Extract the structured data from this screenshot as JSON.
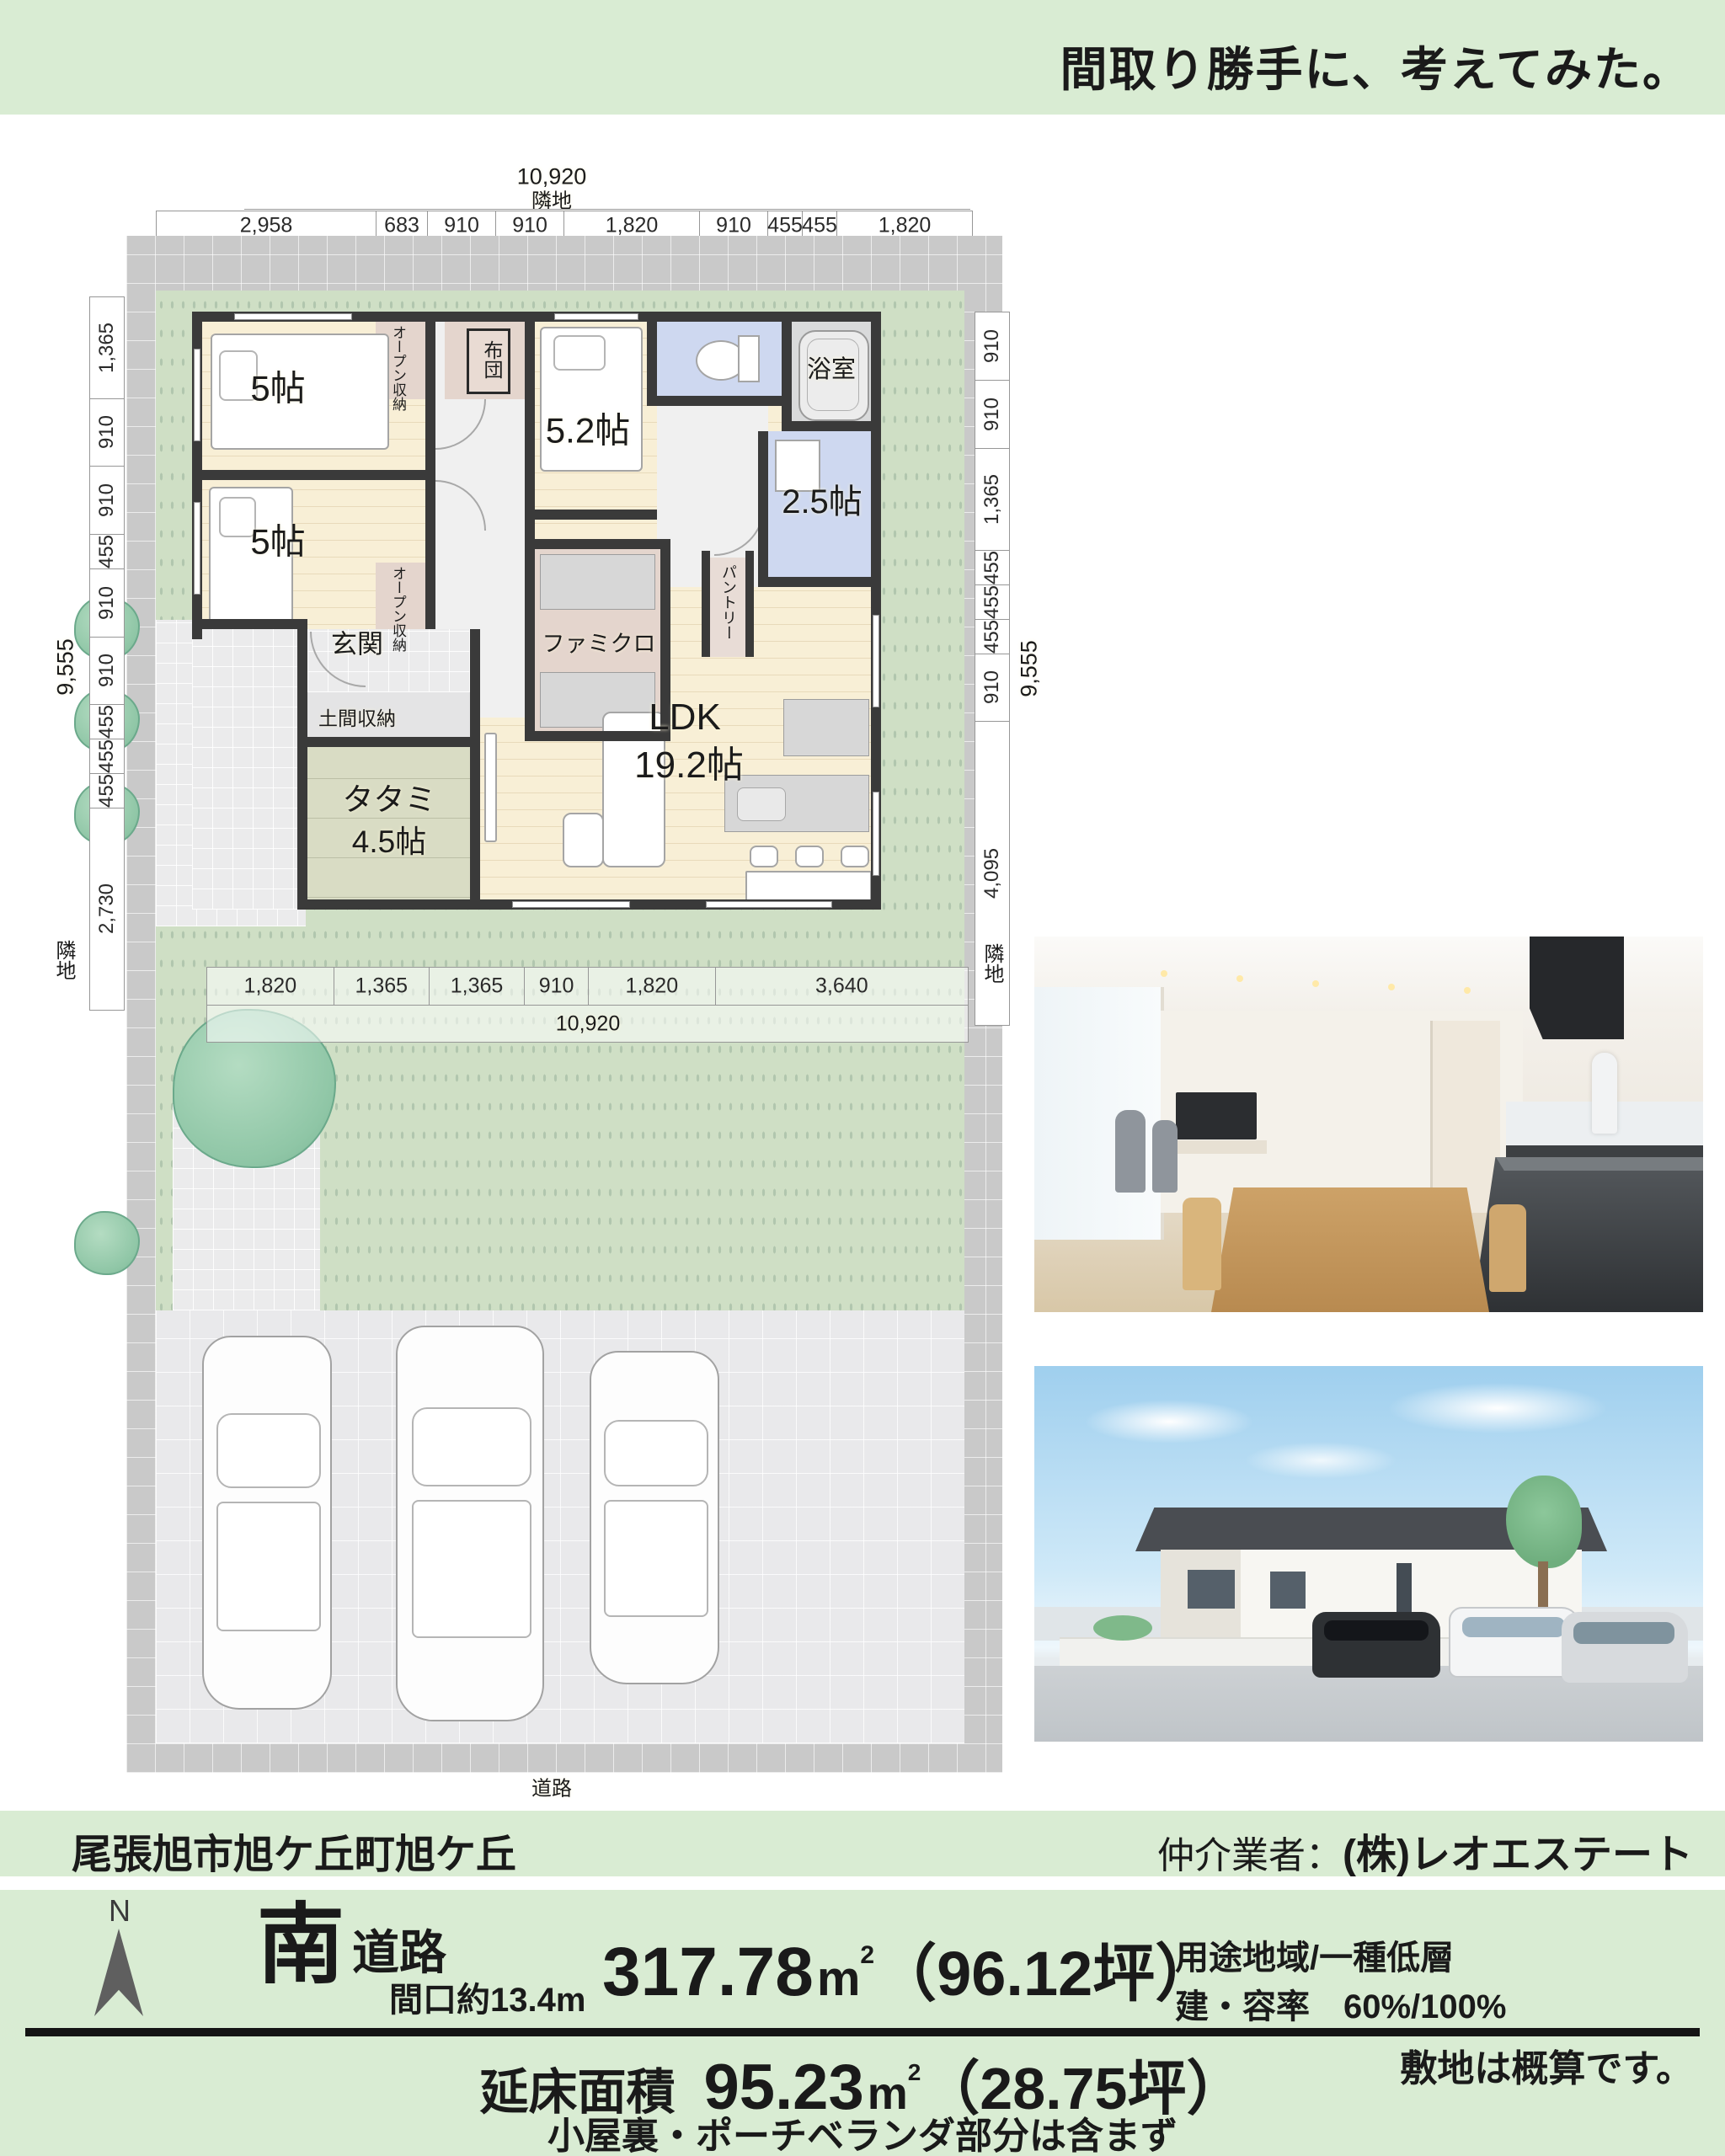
{
  "banner": {
    "title": "間取り勝手に、考えてみた。"
  },
  "plan": {
    "adjacent_top": "隣地",
    "adjacent_left": "隣地",
    "adjacent_right": "隣地",
    "road_label": "道路",
    "dims": {
      "top_total": "10,920",
      "top": [
        "2,958",
        "683",
        "910",
        "910",
        "1,820",
        "910",
        "455",
        "455",
        "1,820"
      ],
      "left_total": "9,555",
      "left": [
        "1,365",
        "910",
        "910",
        "455",
        "910",
        "910",
        "455",
        "455",
        "455",
        "2,730"
      ],
      "right_total": "9,555",
      "right": [
        "910",
        "910",
        "1,365",
        "455",
        "455",
        "455",
        "910",
        "4,095"
      ],
      "bottom": [
        "1,820",
        "1,365",
        "1,365",
        "910",
        "1,820",
        "3,640"
      ],
      "bottom_total": "10,920"
    },
    "rooms": {
      "bedroom1": "5帖",
      "bedroom2": "5.2帖",
      "bedroom3": "5帖",
      "open_storage1": "オープン収納",
      "open_storage2": "オープン収納",
      "futon": "布団",
      "bath": "浴室",
      "washroom": "2.5帖",
      "pantry": "パントリー",
      "family_closet": "ファミクロ",
      "entrance": "玄関",
      "entrance_storage": "土間収納",
      "tatami_line1": "タタミ",
      "tatami_line2": "4.5帖",
      "ldk_line1": "LDK",
      "ldk_line2": "19.2帖"
    }
  },
  "header": {
    "address": "尾張旭市旭ケ丘町旭ケ丘",
    "broker_label": "仲介業者：",
    "broker_name": "(株)レオエステート"
  },
  "details": {
    "compass_n": "N",
    "direction": "南",
    "road": "道路",
    "frontage": "間口約13.4m",
    "land_area_value": "317.78",
    "area_unit": "m",
    "area_unit_sup": "2",
    "land_area_tsubo": "（96.12坪）",
    "zoning": "用途地域/一種低層",
    "ratio": "建・容率　60%/100%",
    "floor_area_label": "延床面積",
    "floor_area_value": "95.23",
    "floor_area_tsubo": "（28.75坪）",
    "floor_area_note": "小屋裏・ポーチベランダ部分は含まず",
    "site_note": "敷地は概算です。"
  }
}
